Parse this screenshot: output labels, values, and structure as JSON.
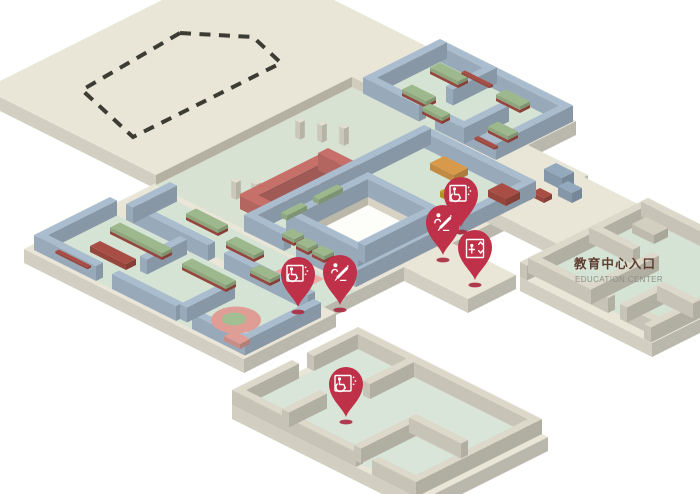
{
  "scene": {
    "labels": {
      "education_entrance_cn": "教育中心入口",
      "education_entrance_en": "EDUCATION CENTER"
    },
    "pins": [
      {
        "id": "accessible-1",
        "icon": "wheelchair-icon",
        "x": 461,
        "y": 196
      },
      {
        "id": "assistance-1",
        "icon": "assistance-icon",
        "x": 443,
        "y": 224
      },
      {
        "id": "elevator-1",
        "icon": "elevator-icon",
        "x": 475,
        "y": 249
      },
      {
        "id": "assistance-2",
        "icon": "assistance-icon",
        "x": 340,
        "y": 274
      },
      {
        "id": "accessible-2",
        "icon": "wheelchair-icon",
        "x": 298,
        "y": 276
      },
      {
        "id": "accessible-3",
        "icon": "wheelchair-icon",
        "x": 346,
        "y": 386
      }
    ],
    "colors": {
      "platform": "#e9e5d7",
      "wall_blue": "#a9bdce",
      "wall_beige": "#ddd9ca",
      "floor_green": "#d5e3d5",
      "sunken_green": "#d7e2d3",
      "courtyard_white": "#fdfdfa",
      "pavilion_red": "#c7706a",
      "exhibit_green": "#9db88d",
      "exhibit_red": "#a84e44",
      "accent_orange": "#d89a4a",
      "accent_gold": "#c8a22e",
      "accent_pink": "#df9d96",
      "pin": "#bf3049",
      "pin_shadow": "#a8293f",
      "label_cn": "#5e3c30",
      "label_en": "#8f8f88",
      "dash": "#3c3c35"
    }
  }
}
